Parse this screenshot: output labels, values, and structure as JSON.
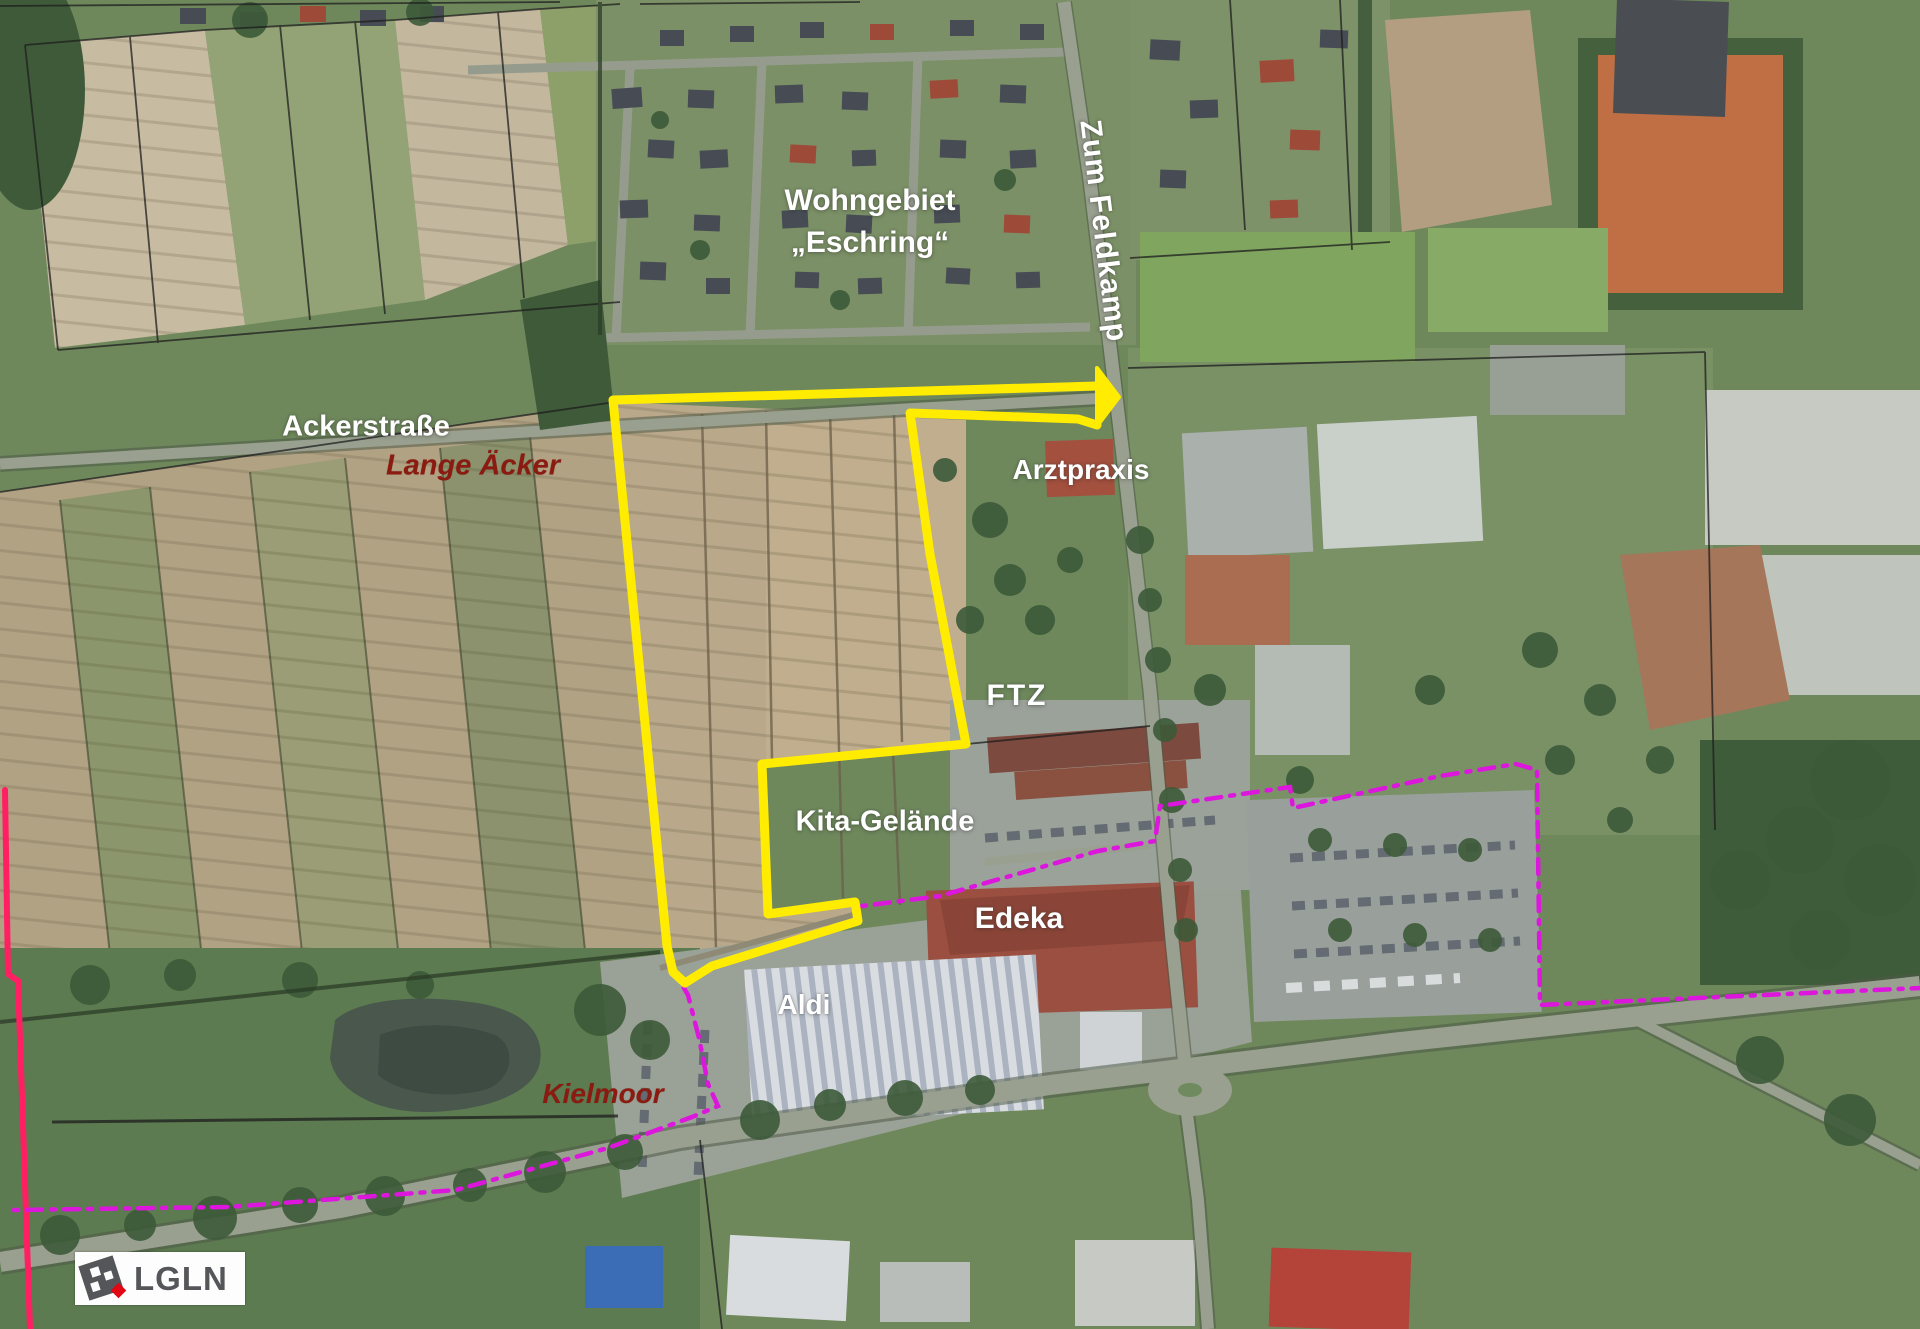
{
  "map": {
    "labels": {
      "wohngebiet_line1": "Wohngebiet",
      "wohngebiet_line2": "„Eschring“",
      "zum_feldkamp": "Zum Feldkamp",
      "ackerstrasse": "Ackerstraße",
      "lange_aecker": "Lange Äcker",
      "arztpraxis": "Arztpraxis",
      "ftz": "FTZ",
      "kita_gelaende": "Kita-Gelände",
      "edeka": "Edeka",
      "aldi": "Aldi",
      "kielmoor": "Kielmoor"
    },
    "legend": {
      "logo_text": "LGLN"
    },
    "colors": {
      "site_boundary_yellow": "#FFEC00",
      "boundary_dashed_magenta": "#DD16DD",
      "boundary_solid_pink": "#FF1F62",
      "label_white": "#FFFFFF",
      "label_dark_red": "#8B1A10",
      "logo_gray": "#55565A",
      "logo_red": "#E30613"
    }
  }
}
